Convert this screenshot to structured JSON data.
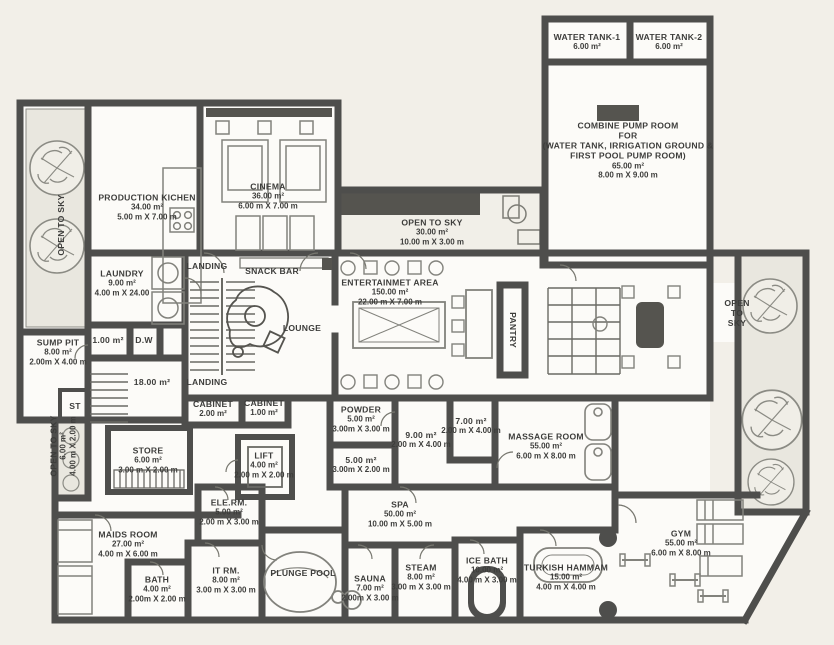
{
  "document": {
    "kind": "architectural floor plan",
    "units": "m"
  },
  "colors": {
    "background": "#f2efe8",
    "wall": "#4e4e4c",
    "room_fill": "#fcfbf8",
    "planter_fill": "#e9e7df",
    "dark_fill": "#55544f",
    "label_text": "#3a3a38"
  },
  "rooms": [
    {
      "id": "water-tank-1",
      "label": "WATER TANK-1",
      "area": "6.00 m²",
      "x": 587,
      "y": 42
    },
    {
      "id": "water-tank-2",
      "label": "WATER TANK-2",
      "area": "6.00 m²",
      "x": 669,
      "y": 42
    },
    {
      "id": "combine-pump-room",
      "label": "COMBINE PUMP ROOM\nFOR\n(WATER TANK, IRRIGATION GROUND &\nFIRST POOL PUMP ROOM)",
      "area": "65.00 m²",
      "dims": "8.00 m X 9.00 m",
      "x": 628,
      "y": 150
    },
    {
      "id": "production-kitchen",
      "label": "PRODUCTION KICHEN",
      "area": "34.00 m²",
      "dims": "5.00 m X 7.00 m",
      "x": 147,
      "y": 207
    },
    {
      "id": "cinema",
      "label": "CINEMA",
      "area": "36.00 m²",
      "dims": "6.00 m X 7.00 m",
      "x": 268,
      "y": 196
    },
    {
      "id": "open-to-sky-court",
      "label": "OPEN TO SKY",
      "area": "30.00 m²",
      "dims": "10.00 m X 3.00 m",
      "x": 432,
      "y": 232
    },
    {
      "id": "open-to-sky-topleft",
      "label": "OPEN TO SKY",
      "x": 61,
      "y": 225,
      "rot": -90
    },
    {
      "id": "laundry",
      "label": "LAUNDRY",
      "area": "9.00 m²",
      "dims": "4.00 m X 24.00",
      "x": 122,
      "y": 283
    },
    {
      "id": "landing-top",
      "label": "LANDING",
      "x": 207,
      "y": 266
    },
    {
      "id": "snack-bar",
      "label": "SNACK BAR",
      "x": 272,
      "y": 271
    },
    {
      "id": "lounge",
      "label": "LOUNGE",
      "x": 302,
      "y": 328
    },
    {
      "id": "entertainment-area",
      "label": "ENTERTAINMET AREA",
      "area": "150.00 m²",
      "dims": "22.00 m X 7.00 m",
      "x": 390,
      "y": 292
    },
    {
      "id": "pantry",
      "label": "PANTRY",
      "x": 513,
      "y": 330,
      "rot": 90
    },
    {
      "id": "open-to-sky-right",
      "label": "OPEN\nTO\nSKY",
      "x": 737,
      "y": 313
    },
    {
      "id": "sump-pit",
      "label": "SUMP PIT",
      "area": "8.00 m²",
      "dims": "2.00m X 4.00 m",
      "x": 58,
      "y": 352
    },
    {
      "id": "room-1sqm",
      "label": "1.00 m²",
      "x": 108,
      "y": 340
    },
    {
      "id": "dumb-waiter",
      "label": "D.W",
      "x": 144,
      "y": 340
    },
    {
      "id": "corridor-18",
      "label": "18.00 m²",
      "x": 152,
      "y": 382
    },
    {
      "id": "landing-bottom",
      "label": "LANDING",
      "x": 207,
      "y": 382
    },
    {
      "id": "cabinet-1",
      "label": "CABINET",
      "area": "2.00 m²",
      "x": 213,
      "y": 409
    },
    {
      "id": "cabinet-2",
      "label": "CABINET",
      "area": "1.00 m²",
      "x": 264,
      "y": 408
    },
    {
      "id": "st-closet",
      "label": "ST",
      "x": 75,
      "y": 406
    },
    {
      "id": "open-to-sky-left",
      "label": "OPEN TO SKY",
      "area": "6.00 m²",
      "dims": "4.00 m X 2.00 m",
      "x": 63,
      "y": 446,
      "rot": -90
    },
    {
      "id": "store",
      "label": "STORE",
      "area": "6.00 m²",
      "dims": "3.00 m X 2.00 m",
      "x": 148,
      "y": 460
    },
    {
      "id": "lift",
      "label": "LIFT",
      "area": "4.00 m²",
      "dims": "2.00 m X 2.00 m",
      "x": 264,
      "y": 465
    },
    {
      "id": "powder",
      "label": "POWDER",
      "area": "5.00 m²",
      "dims": "3.00m X 3.00 m",
      "x": 361,
      "y": 419
    },
    {
      "id": "room-9sqm",
      "label": "9.00 m²",
      "dims": "2.00 m X 4.00 m",
      "x": 421,
      "y": 440
    },
    {
      "id": "room-7sqm",
      "label": "7.00 m²",
      "dims": "2.00 m X 4.00 m",
      "x": 471,
      "y": 426
    },
    {
      "id": "room-5sqm",
      "label": "5.00 m²",
      "dims": "3.00m X 2.00 m",
      "x": 361,
      "y": 465
    },
    {
      "id": "massage-room",
      "label": "MASSAGE ROOM",
      "area": "55.00 m²",
      "dims": "6.00 m X 8.00 m",
      "x": 546,
      "y": 446
    },
    {
      "id": "ele-rm",
      "label": "ELE.RM.",
      "area": "5.00 m²",
      "dims": "2.00 m X 3.00 m",
      "x": 229,
      "y": 512
    },
    {
      "id": "spa",
      "label": "SPA",
      "area": "50.00 m²",
      "dims": "10.00 m X 5.00 m",
      "x": 400,
      "y": 514
    },
    {
      "id": "maids-room",
      "label": "MAIDS ROOM",
      "area": "27.00 m²",
      "dims": "4.00 m X 6.00 m",
      "x": 128,
      "y": 544
    },
    {
      "id": "bath",
      "label": "BATH",
      "area": "4.00 m²",
      "dims": "2.00m X 2.00 m",
      "x": 157,
      "y": 589
    },
    {
      "id": "it-rm",
      "label": "IT RM.",
      "area": "8.00 m²",
      "dims": "3.00 m X 3.00 m",
      "x": 226,
      "y": 580
    },
    {
      "id": "plunge-pool",
      "label": "PLUNGE POOL",
      "x": 303,
      "y": 573
    },
    {
      "id": "sauna",
      "label": "SAUNA",
      "area": "7.00 m²",
      "dims": "2.00m X 3.00 m",
      "x": 370,
      "y": 588
    },
    {
      "id": "steam",
      "label": "STEAM",
      "area": "8.00 m²",
      "dims": "3.00 m X 3.00 m",
      "x": 421,
      "y": 577
    },
    {
      "id": "ice-bath",
      "label": "ICE BATH",
      "area": "10.00 m²",
      "dims": "4.00 m X 3.00 m",
      "x": 487,
      "y": 570
    },
    {
      "id": "turkish-hammam",
      "label": "TURKISH HAMMAM",
      "area": "15.00 m²",
      "dims": "4.00 m X 4.00 m",
      "x": 566,
      "y": 577
    },
    {
      "id": "gym",
      "label": "GYM",
      "area": "55.00 m²",
      "dims": "6.00 m X 8.00 m",
      "x": 681,
      "y": 543
    }
  ]
}
